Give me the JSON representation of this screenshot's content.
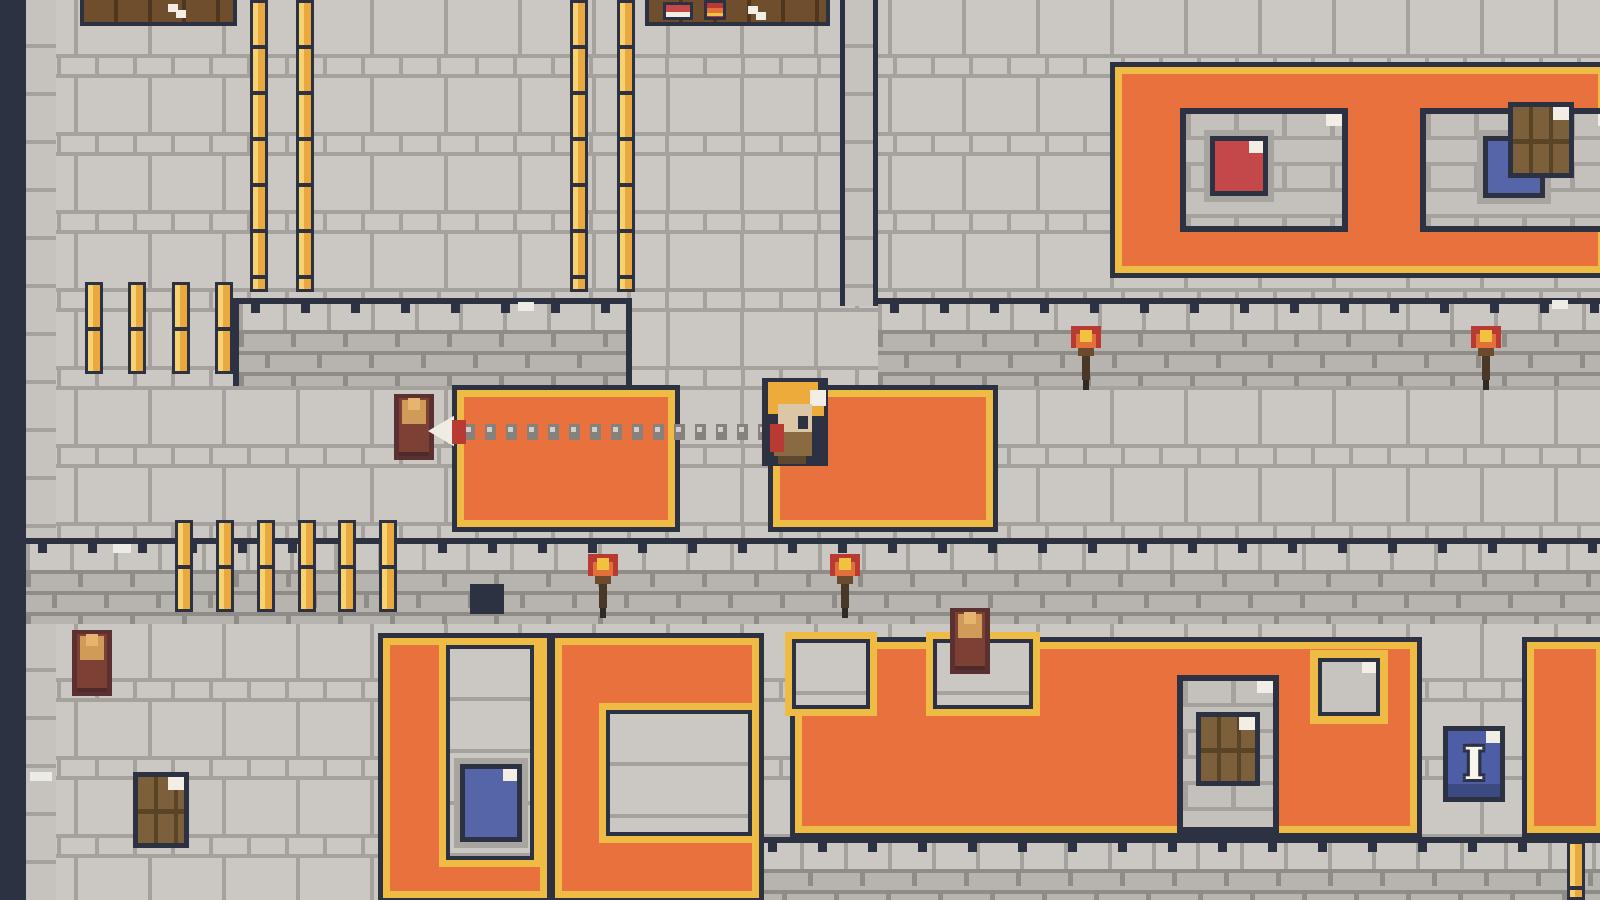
{
  "palette": {
    "navy": "#2d3243",
    "floor": "#cbc7c2",
    "grout": "#a5a19c",
    "grout2": "#8f8b86",
    "face": "#b7b3ae",
    "orange": "#e8713d",
    "goldtrim": "#eebb45",
    "goldbar": "#eaa93f",
    "white": "#f2eee6",
    "red": "#c4474a",
    "blue": "#5565a8",
    "bluesign": "#4e5ea6",
    "wood": "#7c603c",
    "stoneshadow": "#a8a49f",
    "potbody": "#5a3130",
    "potinner": "#7d4035",
    "potsand": "#d09a58",
    "flamered": "#b83a33",
    "flameorange": "#e2703a",
    "flameyellow": "#f0c23f",
    "skin": "#dbc7a6",
    "hair": "#ecab3b",
    "shirt": "#8a6a42",
    "pants": "#5e4930"
  },
  "scene": {
    "objects": [
      {
        "name": "map-left-void",
        "cls": "dark-sq",
        "x": 0,
        "y": 0,
        "w": 26,
        "h": 900,
        "interactable": false
      },
      {
        "name": "wall-edge-column-left",
        "cls": "edge-col",
        "x": 26,
        "y": 0,
        "w": 30,
        "h": 900,
        "interactable": false
      },
      {
        "name": "wall-column-middle",
        "cls": "edge-col navy-sides",
        "x": 840,
        "y": 0,
        "w": 38,
        "h": 306,
        "interactable": false
      },
      {
        "name": "wall-band-shop-south",
        "cls": "band edged",
        "x": 233,
        "y": 298,
        "w": 399,
        "h": 88,
        "interactable": false
      },
      {
        "name": "wall-band-right",
        "cls": "band",
        "x": 878,
        "y": 298,
        "w": 726,
        "h": 88,
        "interactable": false
      },
      {
        "name": "wall-band-lower",
        "cls": "band",
        "x": 26,
        "y": 538,
        "w": 1578,
        "h": 86,
        "interactable": false
      },
      {
        "name": "wall-band-bottom",
        "cls": "band",
        "x": 756,
        "y": 837,
        "w": 848,
        "h": 63,
        "interactable": false
      },
      {
        "name": "carpet-top-right",
        "cls": "carpet",
        "x": 1110,
        "y": 62,
        "w": 500,
        "h": 216,
        "interactable": false
      },
      {
        "name": "stone-window-topright-left",
        "cls": "window",
        "x": 1180,
        "y": 108,
        "w": 168,
        "h": 124,
        "interactable": false
      },
      {
        "name": "red-crate",
        "cls": "crate red ringed",
        "x": 1210,
        "y": 136,
        "w": 58,
        "h": 60,
        "interactable": true
      },
      {
        "name": "stone-window-topright-right",
        "cls": "window",
        "x": 1420,
        "y": 108,
        "w": 200,
        "h": 124,
        "interactable": false
      },
      {
        "name": "blue-crate-topright",
        "cls": "crate blue ringed",
        "x": 1483,
        "y": 136,
        "w": 62,
        "h": 62,
        "interactable": true
      },
      {
        "name": "wood-door-topright",
        "cls": "door",
        "x": 1508,
        "y": 102,
        "w": 66,
        "h": 76,
        "interactable": true
      },
      {
        "name": "shop-table-left",
        "cls": "table",
        "x": 80,
        "y": 0,
        "w": 157,
        "h": 26,
        "interactable": false
      },
      {
        "name": "sparkle-icon",
        "cls": "sparkle",
        "x": 168,
        "y": 4,
        "w": 10,
        "h": 8,
        "interactable": false
      },
      {
        "name": "shop-table-right",
        "cls": "table",
        "x": 645,
        "y": 0,
        "w": 185,
        "h": 26,
        "interactable": false
      },
      {
        "name": "red-book-item",
        "cls": "book-red",
        "x": 663,
        "y": 2,
        "w": 30,
        "h": 18,
        "interactable": true
      },
      {
        "name": "striped-potion-item",
        "cls": "potion",
        "x": 704,
        "y": 0,
        "w": 22,
        "h": 20,
        "interactable": true
      },
      {
        "name": "sparkle-icon",
        "cls": "sparkle",
        "x": 748,
        "y": 6,
        "w": 10,
        "h": 8,
        "interactable": false
      },
      {
        "name": "gold-fence-bar",
        "cls": "gbar",
        "x": 250,
        "y": 0,
        "w": 18,
        "h": 292,
        "interactable": false
      },
      {
        "name": "gold-fence-bar",
        "cls": "gbar",
        "x": 296,
        "y": 0,
        "w": 18,
        "h": 292,
        "interactable": false
      },
      {
        "name": "gold-fence-bar",
        "cls": "gbar",
        "x": 570,
        "y": 0,
        "w": 18,
        "h": 292,
        "interactable": false
      },
      {
        "name": "gold-fence-bar",
        "cls": "gbar",
        "x": 617,
        "y": 0,
        "w": 18,
        "h": 292,
        "interactable": false
      },
      {
        "name": "gold-fence-bar",
        "cls": "gbar",
        "x": 85,
        "y": 282,
        "w": 18,
        "h": 92,
        "interactable": false
      },
      {
        "name": "gold-fence-bar",
        "cls": "gbar",
        "x": 128,
        "y": 282,
        "w": 18,
        "h": 92,
        "interactable": false
      },
      {
        "name": "gold-fence-bar",
        "cls": "gbar",
        "x": 172,
        "y": 282,
        "w": 18,
        "h": 92,
        "interactable": false
      },
      {
        "name": "gold-fence-bar",
        "cls": "gbar",
        "x": 215,
        "y": 282,
        "w": 18,
        "h": 92,
        "interactable": false
      },
      {
        "name": "gold-fence-bar",
        "cls": "gbar",
        "x": 175,
        "y": 520,
        "w": 18,
        "h": 92,
        "interactable": false
      },
      {
        "name": "gold-fence-bar",
        "cls": "gbar",
        "x": 216,
        "y": 520,
        "w": 18,
        "h": 92,
        "interactable": false
      },
      {
        "name": "gold-fence-bar",
        "cls": "gbar",
        "x": 257,
        "y": 520,
        "w": 18,
        "h": 92,
        "interactable": false
      },
      {
        "name": "gold-fence-bar",
        "cls": "gbar",
        "x": 298,
        "y": 520,
        "w": 18,
        "h": 92,
        "interactable": false
      },
      {
        "name": "gold-fence-bar",
        "cls": "gbar",
        "x": 338,
        "y": 520,
        "w": 18,
        "h": 92,
        "interactable": false
      },
      {
        "name": "gold-fence-bar",
        "cls": "gbar",
        "x": 379,
        "y": 520,
        "w": 18,
        "h": 92,
        "interactable": false
      },
      {
        "name": "wall-hole",
        "cls": "dark-sq",
        "x": 470,
        "y": 584,
        "w": 34,
        "h": 30,
        "interactable": false
      },
      {
        "name": "torch-icon",
        "cls": "torch",
        "x": 1071,
        "y": 326,
        "w": 30,
        "h": 64,
        "interactable": false
      },
      {
        "name": "torch-icon",
        "cls": "torch",
        "x": 1471,
        "y": 326,
        "w": 30,
        "h": 64,
        "interactable": false
      },
      {
        "name": "torch-icon",
        "cls": "torch",
        "x": 588,
        "y": 554,
        "w": 30,
        "h": 64,
        "interactable": false
      },
      {
        "name": "torch-icon",
        "cls": "torch",
        "x": 830,
        "y": 554,
        "w": 30,
        "h": 64,
        "interactable": false
      },
      {
        "name": "carpet-mid-left",
        "cls": "carpet",
        "x": 452,
        "y": 385,
        "w": 228,
        "h": 147,
        "interactable": false
      },
      {
        "name": "carpet-mid-right",
        "cls": "carpet",
        "x": 768,
        "y": 385,
        "w": 230,
        "h": 147,
        "interactable": false
      },
      {
        "name": "clay-pot",
        "cls": "pot",
        "x": 392,
        "y": 392,
        "w": 44,
        "h": 70,
        "interactable": true
      },
      {
        "name": "grapple-chain",
        "cls": "chain",
        "x": 464,
        "y": 424,
        "w": 298,
        "h": 16,
        "interactable": false
      },
      {
        "name": "grapple-arrowhead-icon",
        "cls": "arrow",
        "x": 428,
        "y": 412,
        "w": 26,
        "h": 38,
        "interactable": false
      },
      {
        "name": "grapple-shaft",
        "cls": "arrow-red",
        "x": 452,
        "y": 420,
        "w": 14,
        "h": 24,
        "interactable": false
      },
      {
        "name": "player-character",
        "cls": "character",
        "x": 758,
        "y": 378,
        "w": 82,
        "h": 92,
        "interactable": true
      },
      {
        "name": "grapple-anchor",
        "cls": "arrow-red",
        "x": 770,
        "y": 424,
        "w": 14,
        "h": 28,
        "interactable": false
      },
      {
        "name": "carpet-bottomleft",
        "cls": "carpet",
        "x": 378,
        "y": 633,
        "w": 174,
        "h": 270,
        "interactable": false
      },
      {
        "name": "stone-notch-bottomleft",
        "cls": "notch",
        "x": 446,
        "y": 645,
        "w": 88,
        "h": 215,
        "interactable": false
      },
      {
        "name": "blue-crate-bottom",
        "cls": "crate blue ringed",
        "x": 460,
        "y": 764,
        "w": 62,
        "h": 78,
        "interactable": true
      },
      {
        "name": "carpet-bottommid",
        "cls": "carpet",
        "x": 550,
        "y": 633,
        "w": 214,
        "h": 270,
        "interactable": false
      },
      {
        "name": "stone-notch-bottommid",
        "cls": "notch",
        "x": 606,
        "y": 710,
        "w": 146,
        "h": 126,
        "interactable": false
      },
      {
        "name": "carpet-bottom-main",
        "cls": "carpet",
        "x": 790,
        "y": 637,
        "w": 632,
        "h": 201,
        "interactable": false
      },
      {
        "name": "stone-notch-main-left",
        "cls": "notch",
        "x": 792,
        "y": 639,
        "w": 78,
        "h": 70,
        "interactable": false
      },
      {
        "name": "stone-notch-main-pot",
        "cls": "notch",
        "x": 933,
        "y": 639,
        "w": 100,
        "h": 70,
        "interactable": false
      },
      {
        "name": "clay-pot",
        "cls": "pot",
        "x": 948,
        "y": 606,
        "w": 44,
        "h": 70,
        "interactable": true
      },
      {
        "name": "stone-window-bottom",
        "cls": "window",
        "x": 1177,
        "y": 675,
        "w": 102,
        "h": 158,
        "interactable": false
      },
      {
        "name": "wood-door-bottom",
        "cls": "door",
        "x": 1196,
        "y": 712,
        "w": 64,
        "h": 74,
        "interactable": true
      },
      {
        "name": "gray-sign",
        "cls": "sign-gray",
        "x": 1318,
        "y": 658,
        "w": 62,
        "h": 58,
        "interactable": true
      },
      {
        "name": "carpet-bottomright",
        "cls": "carpet",
        "x": 1522,
        "y": 637,
        "w": 86,
        "h": 201,
        "interactable": false
      },
      {
        "name": "info-sign",
        "cls": "sign-blue",
        "x": 1443,
        "y": 726,
        "w": 62,
        "h": 76,
        "interactable": true,
        "text": "I"
      },
      {
        "name": "clay-pot",
        "cls": "pot",
        "x": 70,
        "y": 628,
        "w": 44,
        "h": 70,
        "interactable": true
      },
      {
        "name": "wood-door-bottomleft",
        "cls": "door",
        "x": 133,
        "y": 772,
        "w": 56,
        "h": 76,
        "interactable": true
      },
      {
        "name": "gold-fence-bar",
        "cls": "gbar",
        "x": 1567,
        "y": 841,
        "w": 18,
        "h": 59,
        "interactable": false
      },
      {
        "name": "floor-highlight",
        "cls": "speck",
        "x": 113,
        "y": 544,
        "w": 18,
        "h": 9,
        "interactable": false
      },
      {
        "name": "floor-highlight",
        "cls": "speck",
        "x": 30,
        "y": 772,
        "w": 22,
        "h": 9,
        "interactable": false
      },
      {
        "name": "floor-highlight",
        "cls": "speck",
        "x": 518,
        "y": 302,
        "w": 16,
        "h": 9,
        "interactable": false
      },
      {
        "name": "floor-highlight",
        "cls": "speck",
        "x": 1552,
        "y": 300,
        "w": 16,
        "h": 9,
        "interactable": false
      }
    ]
  }
}
